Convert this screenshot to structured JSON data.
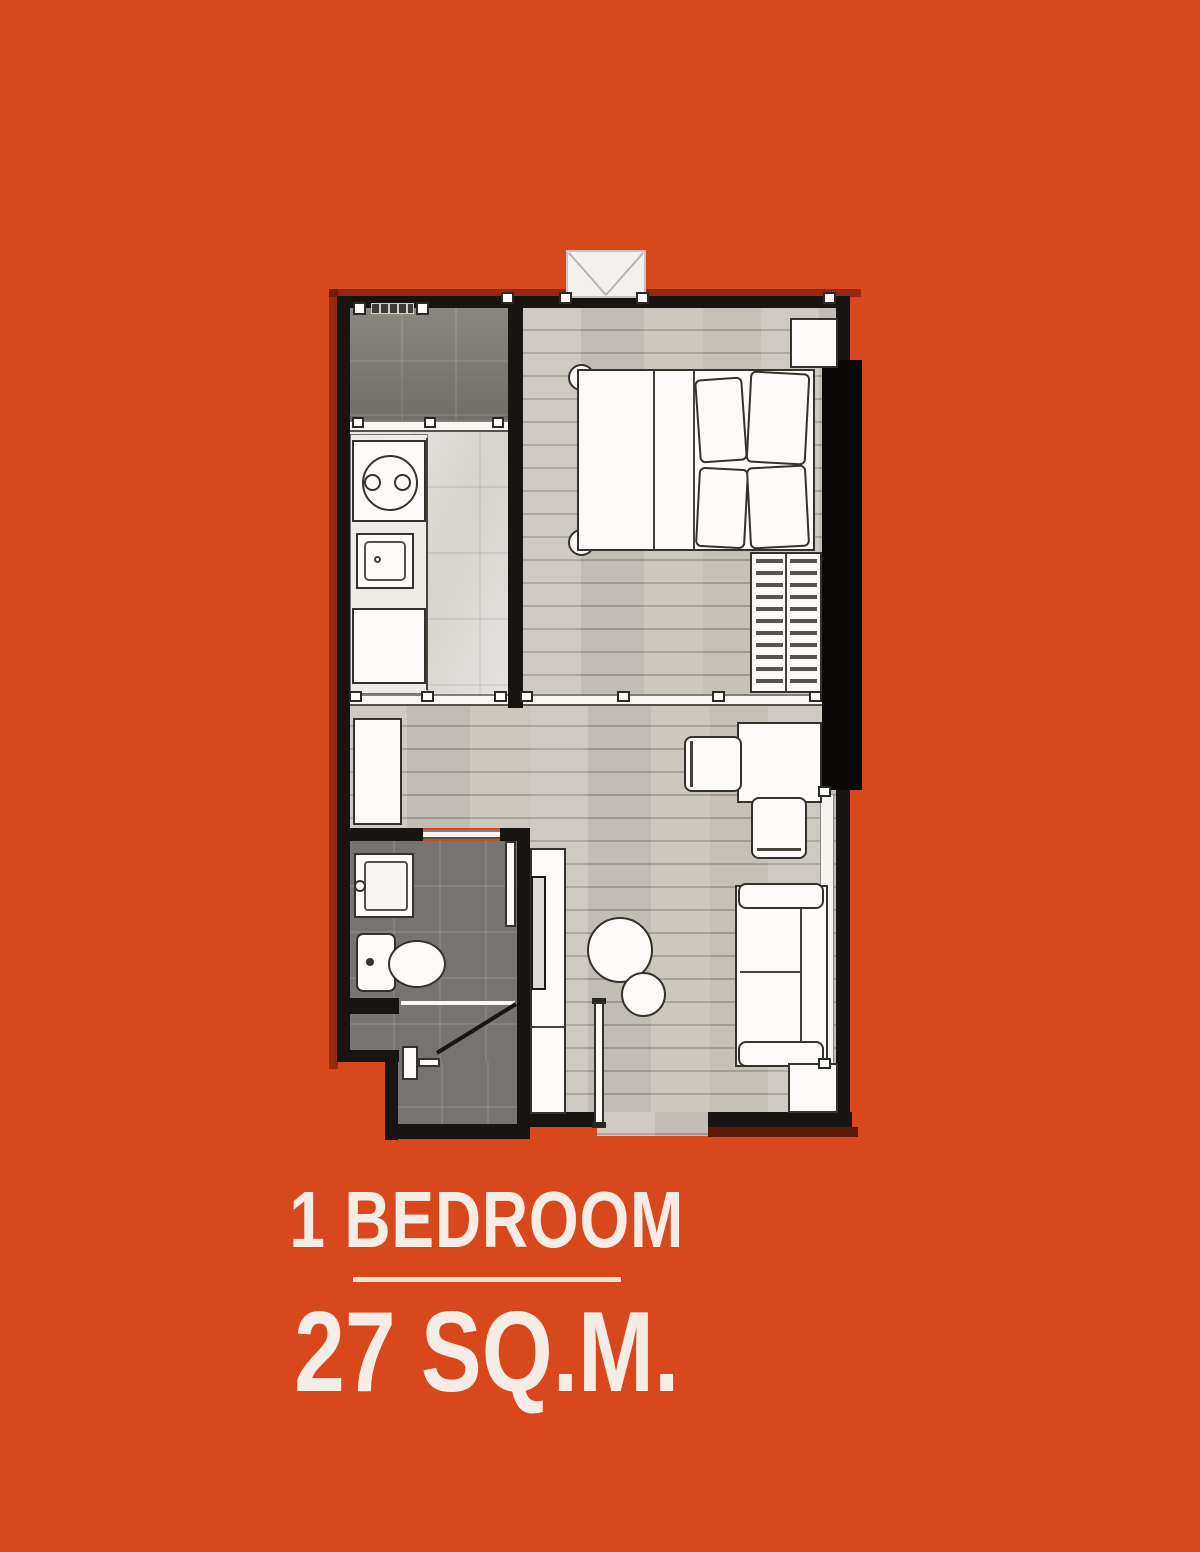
{
  "poster": {
    "unit_type": "1 BEDROOM",
    "unit_area": "27 SQ.M."
  },
  "colors": {
    "background": "#d9471d",
    "wall": "#171411",
    "wood_floor": "#c9c4bc",
    "kitchen_marble_floor": "#dad7d2",
    "bathroom_tile": "#767471",
    "utility_tile": "#838078",
    "furniture_fill": "#fcfbf9",
    "furniture_line": "#35322d",
    "text": "#f5ede5",
    "divider_line": "#f2e2d6"
  },
  "floorplan": {
    "features": [
      "utility-area",
      "kitchen-counter",
      "two-burner-stove",
      "kitchen-sink",
      "refrigerator-cabinet",
      "bedroom",
      "double-bed",
      "pillows",
      "wardrobe-with-hangers",
      "bedside-shelf",
      "air-conditioning-unit",
      "window",
      "desk",
      "desk-chair",
      "stool",
      "tv-console",
      "television",
      "sofa",
      "side-table",
      "round-coffee-tables",
      "bathroom",
      "wash-basin",
      "toilet",
      "shower-with-glass-door",
      "bathroom-door",
      "entrance-door"
    ]
  }
}
